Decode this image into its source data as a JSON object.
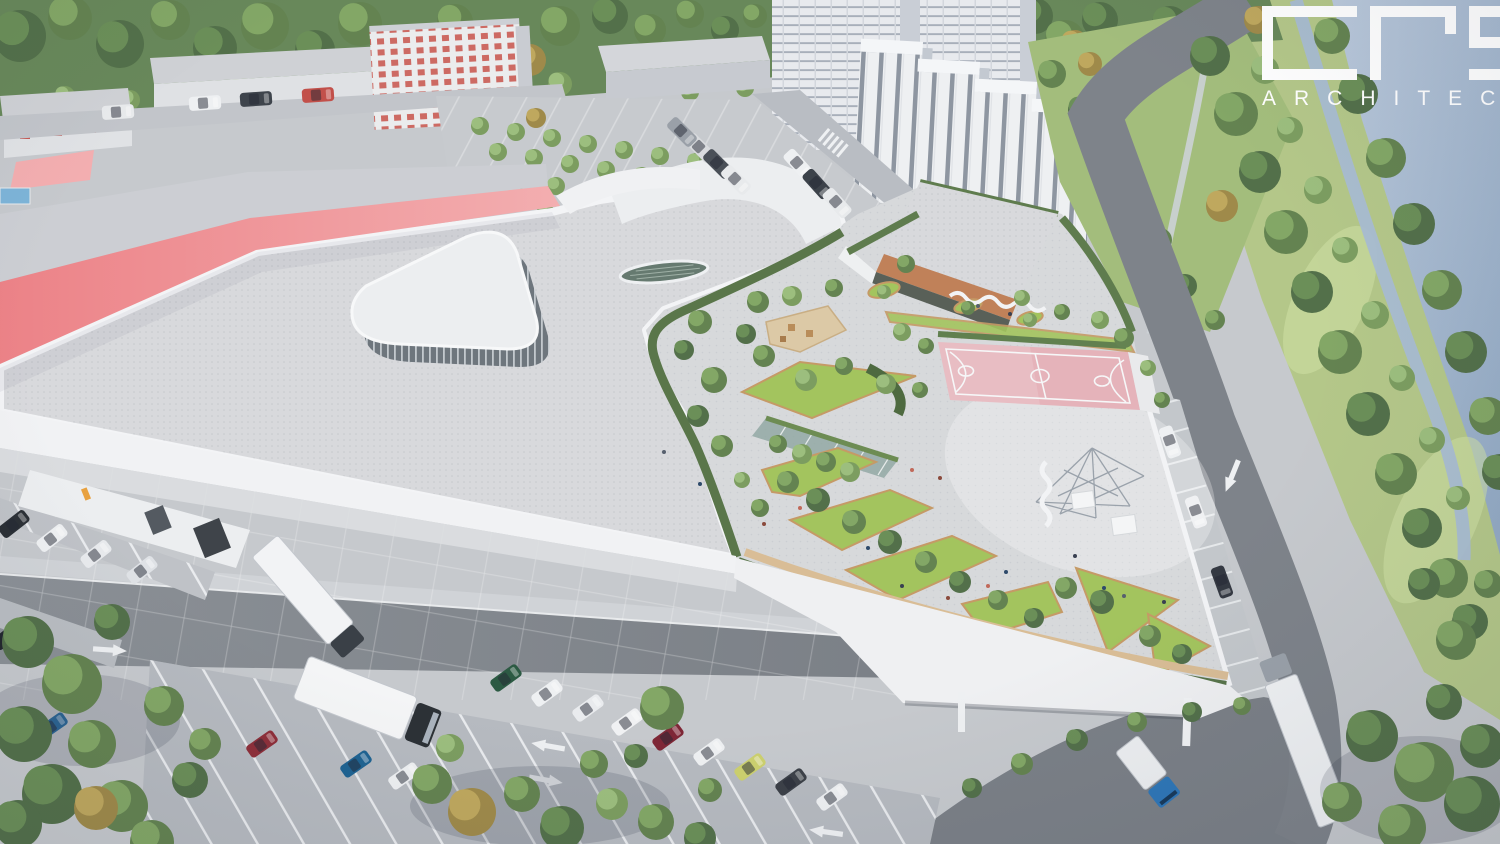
{
  "logo": {
    "wordmark": "crs",
    "wordmark_letters": [
      "c",
      "r",
      "s"
    ],
    "tagline": "ARCHITEC",
    "color": "#ffffff"
  },
  "palette": {
    "water": "#9db0c9",
    "water-light": "#c2cfe0",
    "riverbank-grass": "#b4c789",
    "slope-grass": "#a3bd7c",
    "foliage-dark": "#53704a",
    "foliage-mid": "#648351",
    "foliage-light": "#7c9d60",
    "foliage-autumn": "#9f8a4a",
    "roof-gray": "#d8d9dc",
    "parapet-white": "#f2f3f5",
    "coral": "#ee8e92",
    "coral-light": "#f3aeb0",
    "terracotta": "#c08159",
    "lawn-green": "#a3c45e",
    "lawn-edge-tan": "#c59a66",
    "court-pink": "#e5b3ba",
    "court-lines": "#f6f7f8",
    "pavement-light": "#d6d8da",
    "pavement-mid": "#c6c9cd",
    "asphalt": "#82878e",
    "pool-blue": "#7db4d8"
  }
}
